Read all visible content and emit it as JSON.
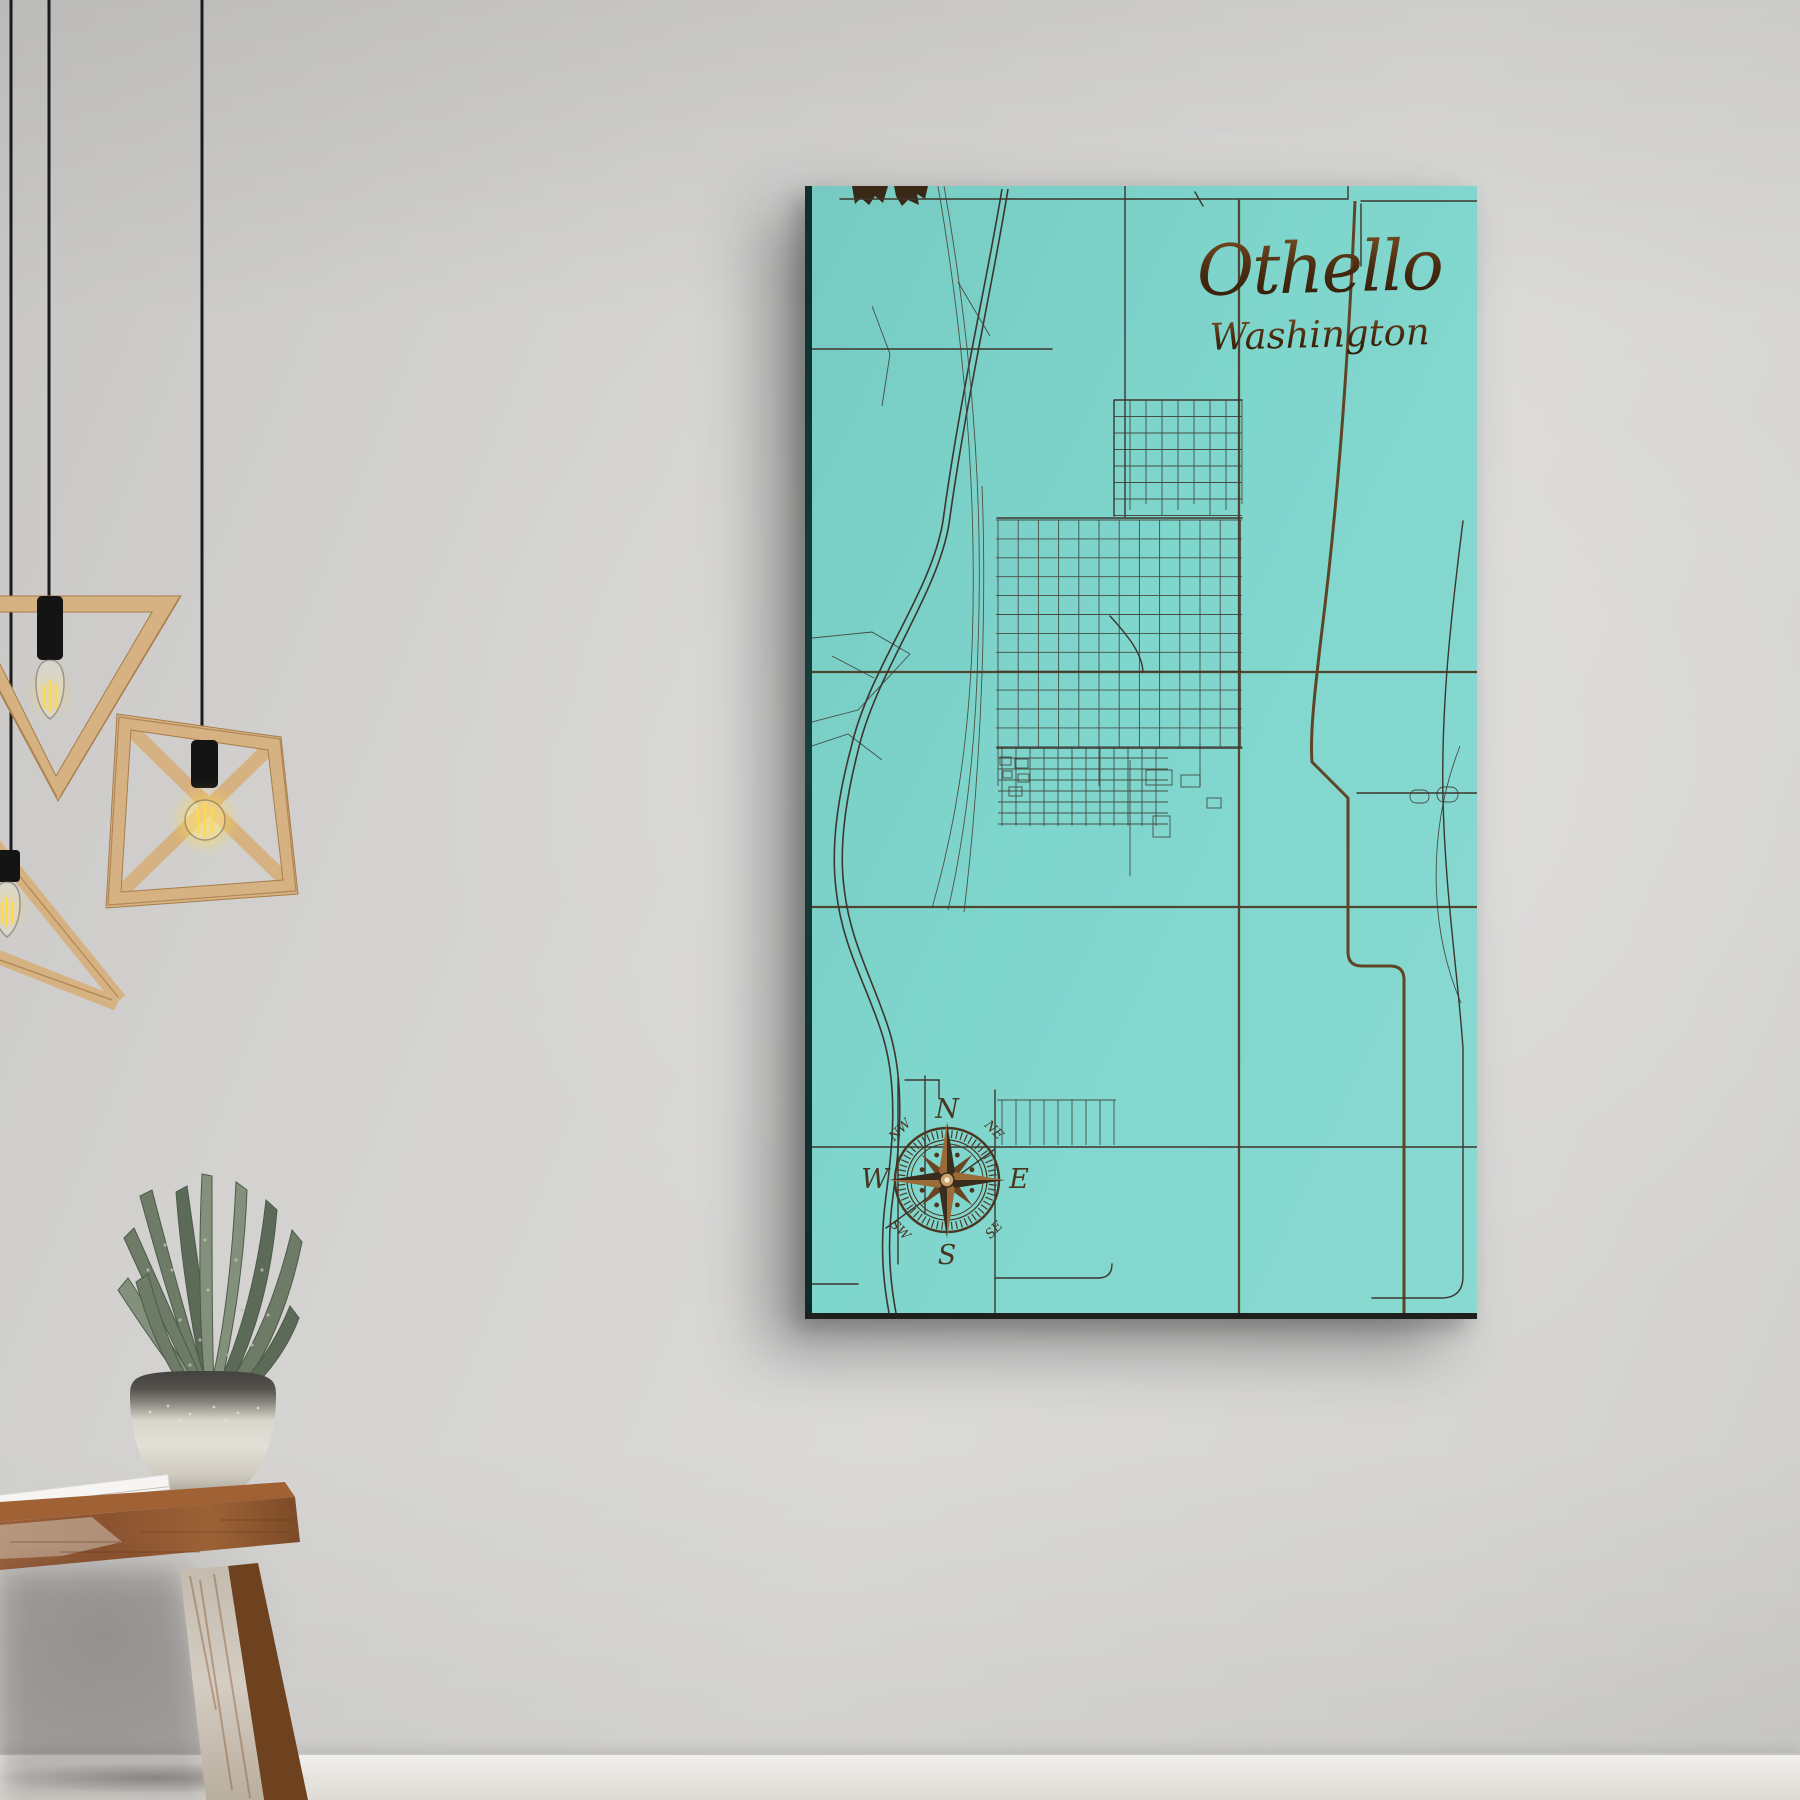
{
  "artwork": {
    "title": "Othello",
    "subtitle": "Washington",
    "compass": {
      "n": "N",
      "e": "E",
      "s": "S",
      "w": "W",
      "ne": "NE",
      "nw": "NW",
      "se": "SE",
      "sw": "SW"
    },
    "colors": {
      "canvas_teal": "#7fd6cd",
      "engraving_dark": "#3c362e",
      "engraving_mid": "#52452f",
      "engraving_brown": "#5f4526",
      "title_brown_dark": "#46290f",
      "title_brown_light": "#7c5226",
      "compass_brown": "#4a3520"
    }
  },
  "scene": {
    "colors": {
      "wood_light": "#d6b181",
      "wood_dark": "#a87c4a",
      "cord_black": "#1b1b1b",
      "bulb_glow": "#ffd94d",
      "stool_wood": "#8a5230",
      "stool_wood_deep": "#6e421f",
      "whitewash": "#d5cdc2",
      "pot_dark_band": "#43413d",
      "pot_body": "#e2dfd6",
      "plant_green_dark": "#5c6a58",
      "plant_green_mid": "#6d7b67",
      "plant_green_light": "#83907b",
      "book_white": "#f6f5f3"
    }
  }
}
